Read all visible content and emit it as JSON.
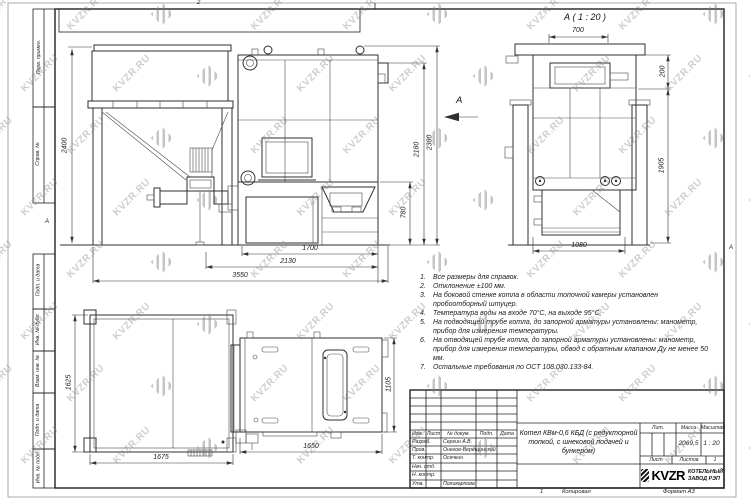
{
  "watermark": {
    "text": "KVZR.RU"
  },
  "sheet": {
    "zone_top": "2",
    "zone_bottom": "1",
    "zone_left": "А",
    "zone_right": "А",
    "copied_label": "Копировал",
    "format_label": "Формат А3"
  },
  "margin_labels": [
    "Перв. примен.",
    "Справ. №",
    "Подп. и дата",
    "Инв. № дубл.",
    "Взам. инв. №",
    "Подп. и дата",
    "Инв. № подл."
  ],
  "views": {
    "front_bunker": {
      "dim_height": "2400"
    },
    "side": {
      "dim_grate": "1700",
      "dim_mid": "2130",
      "dim_total": "3550",
      "dim_ash_height": "780",
      "dim_body_height": "2180",
      "dim_total_height": "2380",
      "view_arrow": "А"
    },
    "detail": {
      "title": "А ( 1 : 20 )",
      "dim_top": "700",
      "dim_neck": "200",
      "dim_height": "1905",
      "dim_bottom": "1080"
    },
    "plan_bunker": {
      "dim_depth": "1625",
      "dim_width": "1675"
    },
    "plan_boiler": {
      "dim_width": "1650",
      "dim_depth": "1105"
    }
  },
  "notes": [
    {
      "num": "1.",
      "text": "Все размеры для справок."
    },
    {
      "num": "2.",
      "text": "Отклонение ±100 мм."
    },
    {
      "num": "3.",
      "text": "На боковой стенке котла в области топочной камеры установлен пробоотборный штуцер."
    },
    {
      "num": "4.",
      "text": "Температура воды на входе 70°С, на выходе 95°С."
    },
    {
      "num": "5.",
      "text": "На подводящей трубе котла, до запорной арматуры установлены: манометр, прибор для измерения температуры."
    },
    {
      "num": "6.",
      "text": "На отводящей трубе котла, до запорной арматуры установлены: манометр, прибор для измерения температуры, обвод с обратным клапаном Ду не менее 50 мм."
    },
    {
      "num": "7.",
      "text": "Остальные требования по ОСТ 108.030.133-84."
    }
  ],
  "title_block": {
    "header": {
      "izm": "Изм.",
      "list": "Лист",
      "doc": "№ докум.",
      "sign": "Подп.",
      "date": "Дата"
    },
    "rows": [
      {
        "role": "Разраб.",
        "name": "Сергин А.В."
      },
      {
        "role": "Пров.",
        "name": "Онегов-Верещинский"
      },
      {
        "role": "Т. контр.",
        "name": "Осечкин"
      },
      {
        "role": "Нач. отд.",
        "name": ""
      },
      {
        "role": "Н. контр.",
        "name": ""
      },
      {
        "role": "Утв.",
        "name": "Поликарпова"
      }
    ],
    "doc_title": "Котел КВм-0,6 КБД (с редукторной топкой, с шнековой подачей и бункером)",
    "lit_label": "Лит.",
    "mass_label": "Масса",
    "scale_label": "Масштаб",
    "mass_value": "2069,5",
    "scale_value": "1 : 20",
    "sheet_label": "Лист",
    "sheets_label": "Листов",
    "sheets_value": "1",
    "company": {
      "logo": "KVZR",
      "line1": "КОТЕЛЬНЫЙ",
      "line2": "ЗАВОД РЭП"
    }
  }
}
